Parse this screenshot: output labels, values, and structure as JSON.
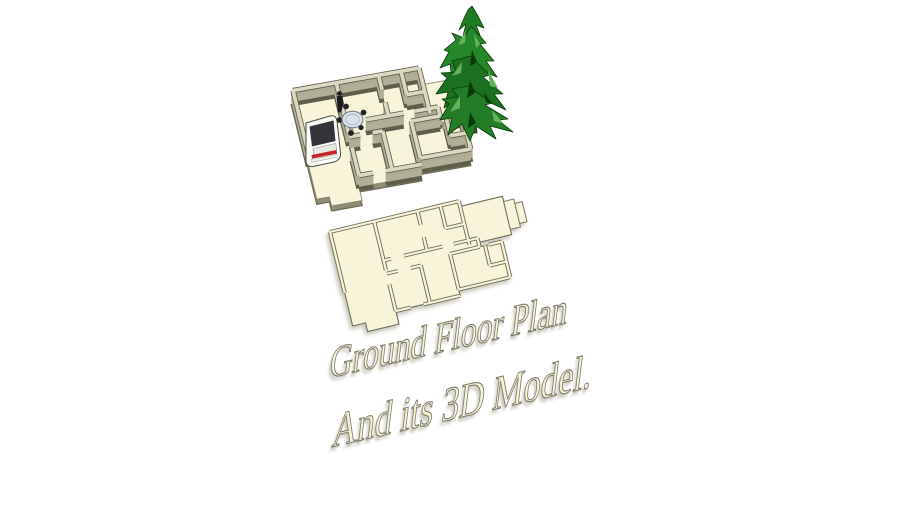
{
  "page": {
    "background": "#ffffff",
    "width": 910,
    "height": 512
  },
  "caption": {
    "line1": "Ground Floor Plan",
    "line2": "And its 3D Model.",
    "text_fill": "#f5f2d8",
    "text_outline": "#7d7b68"
  },
  "scene": {
    "objects": [
      "house-3d-model",
      "pine-tree",
      "car",
      "dining-table-set",
      "person-figure",
      "floor-plan-2d",
      "porch-steps"
    ],
    "colors": {
      "floor_cream": "#f7f4da",
      "wall_top": "#dbd8c3",
      "wall_side": "#b2af99",
      "wall_outline": "#5f5e4b",
      "slab_side": "#8f8c74",
      "plan_outline": "#716f5b",
      "tree_green_dark": "#0a3a0c",
      "tree_green_mid": "#1f7a22",
      "tree_green_light": "#66b25c",
      "car_body": "#fcfcf9",
      "car_glass": "#33333a",
      "car_taillight": "#c2272c",
      "table_top": "#d9e2e9",
      "chair_dark": "#232323"
    }
  }
}
